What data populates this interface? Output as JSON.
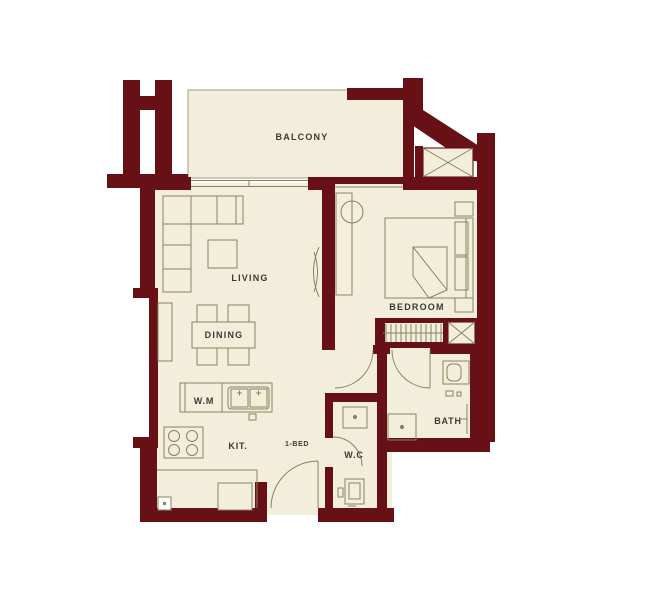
{
  "plan_title": "1-BED apartment floor plan",
  "colors": {
    "wall": "#671015",
    "floor": "#f3eedb",
    "line": "#84855f",
    "edge": "#b3ad8e",
    "text": "#3b3b31",
    "background": "#ffffff"
  },
  "labels": {
    "balcony": "BALCONY",
    "living": "LIVING",
    "dining": "DINING",
    "bedroom": "BEDROOM",
    "bath": "BATH",
    "wc": "W.C",
    "kitchen": "KIT.",
    "washer": "W.M",
    "unit": "1-BED"
  }
}
